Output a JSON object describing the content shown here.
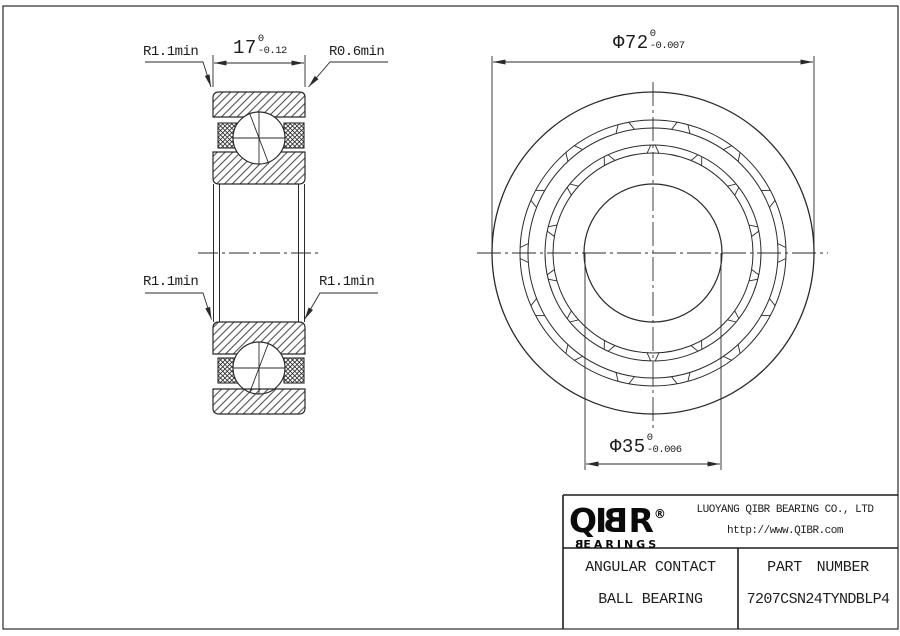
{
  "colors": {
    "line": "#2a2a2a",
    "text": "#1d1d1d",
    "background": "#ffffff",
    "logo": "#0b0b0b"
  },
  "section_view": {
    "width_dim": {
      "value": "17",
      "tol_upper": "0",
      "tol_lower": "-0.12"
    },
    "chamfer_top_left": "R1.1min",
    "chamfer_top_right": "R0.6min",
    "chamfer_mid_left": "R1.1min",
    "chamfer_mid_right": "R1.1min"
  },
  "front_view": {
    "outer_dia_dim": {
      "value": "Φ72",
      "tol_upper": "0",
      "tol_lower": "-0.007"
    },
    "bore_dia_dim": {
      "value": "Φ35",
      "tol_upper": "0",
      "tol_lower": "-0.006"
    }
  },
  "title_block": {
    "logo": {
      "pre": "QI",
      "mirrored_b": "B",
      "post": "R",
      "reg": "®",
      "sub_mirrored_b": "B",
      "sub_rest": "EARINGS"
    },
    "company": "LUOYANG QIBR BEARING CO., LTD",
    "website": "http://www.QIBR.com",
    "product_name_line1": "ANGULAR CONTACT",
    "product_name_line2": "BALL BEARING",
    "part_number_label": "PART NUMBER",
    "part_number": "7207CSN24TYNDBLP4"
  }
}
